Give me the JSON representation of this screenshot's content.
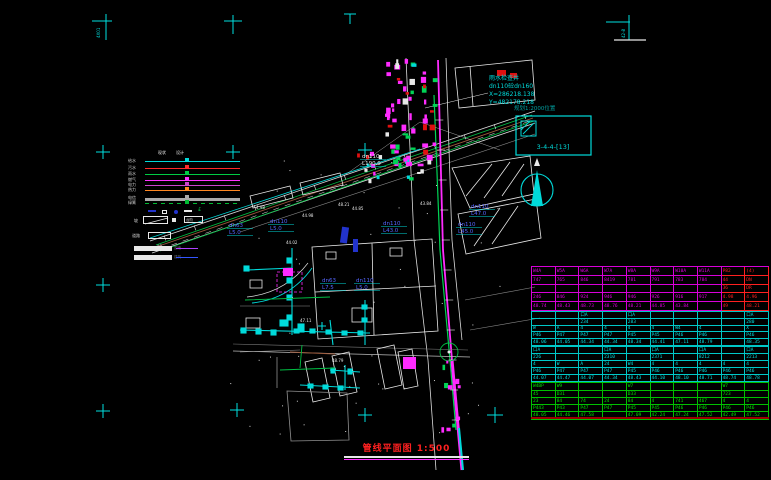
{
  "title_block": {
    "title": "管线平面图",
    "scale": "1:500"
  },
  "corner_notes": {
    "tl": "4X01",
    "tr": "42-8"
  },
  "survey_note": {
    "line1": "雨水检查井",
    "line2": "dn110砼dn160",
    "line3": "X=286218.138",
    "line4": "Y=482178.218"
  },
  "index_note": "规划1:2000位置",
  "detail_box": {
    "label": "3-4-4-[13]"
  },
  "north_label": "北",
  "legend": {
    "col_headers": [
      "现状",
      "设计"
    ],
    "lines": [
      {
        "label": "给水",
        "color": "#00dada",
        "style": "solid"
      },
      {
        "label": "污水",
        "color": "#ff2a2a",
        "style": "solid"
      },
      {
        "label": "雨水",
        "color": "#00cc44",
        "style": "solid"
      },
      {
        "label": "燃气",
        "color": "#ff33ff",
        "style": "solid"
      },
      {
        "label": "电力",
        "color": "#cc44cc",
        "style": "solid"
      },
      {
        "label": "热力",
        "color": "#ff8822",
        "style": "solid"
      },
      {
        "label": "电信",
        "color": "#aaaaaa",
        "style": "thick"
      },
      {
        "label": "绿篱",
        "color": "#00bb33",
        "style": "dashed"
      }
    ],
    "extra_labels": {
      "slope": "坡",
      "steps": "台阶",
      "road": "道路",
      "road_tag": "AB"
    },
    "bars": [
      "围墙",
      "建筑"
    ]
  },
  "pipe_labels": [
    {
      "x": 229,
      "y": 227,
      "l1": "dn63",
      "l2": "L5.0",
      "c": "#5566ff"
    },
    {
      "x": 270,
      "y": 223,
      "l1": "dn110",
      "l2": "L5.0",
      "c": "#5566ff"
    },
    {
      "x": 383,
      "y": 225,
      "l1": "dn110",
      "l2": "L43.0",
      "c": "#5566ff"
    },
    {
      "x": 458,
      "y": 226,
      "l1": "dn110",
      "l2": "L45.0",
      "c": "#5566ff"
    },
    {
      "x": 471,
      "y": 208,
      "l1": "dn110",
      "l2": "L47.0",
      "c": "#5566ff"
    },
    {
      "x": 362,
      "y": 158,
      "l1": "dn110",
      "l2": "L190.0",
      "c": "#e8e8e8"
    },
    {
      "x": 322,
      "y": 282,
      "l1": "dn63",
      "l2": "L7.5",
      "c": "#5566ff"
    },
    {
      "x": 356,
      "y": 282,
      "l1": "dn110",
      "l2": "L5.0",
      "c": "#5566ff"
    }
  ],
  "spot_elevations": [
    {
      "x": 302,
      "y": 217,
      "t": "44.98"
    },
    {
      "x": 338,
      "y": 206,
      "t": "48.21"
    },
    {
      "x": 256,
      "y": 209,
      "t": "4.98"
    },
    {
      "x": 286,
      "y": 244,
      "t": "44.02"
    },
    {
      "x": 352,
      "y": 210,
      "t": "44.85"
    },
    {
      "x": 420,
      "y": 205,
      "t": "43.84"
    },
    {
      "x": 300,
      "y": 322,
      "t": "47.11"
    },
    {
      "x": 332,
      "y": 362,
      "t": "48.79"
    }
  ],
  "tables": {
    "sections": [
      {
        "name": "rain-wells",
        "border": "#d800d8",
        "text": "#e000e0",
        "alt_border": "#ff2020",
        "alt_text": "#ff2020",
        "alt_cols": 2,
        "rows": [
          [
            "W4A",
            "W5A",
            "W6A",
            "W7A",
            "W8A",
            "W9A",
            "W10A",
            "W11A",
            "P82",
            "(4)"
          ],
          [
            "747",
            "765",
            "846",
            "8419",
            "781",
            "791",
            "783",
            "784",
            "44",
            "DN"
          ],
          [
            "",
            "",
            "",
            "",
            "",
            "",
            "",
            "",
            "36",
            "DR"
          ],
          [
            "246",
            "846",
            "924",
            "946",
            "946",
            "926",
            "916",
            "917",
            "4.98",
            "4.96"
          ],
          [
            "48.74",
            "48.43",
            "48.73",
            "48.76",
            "48.21",
            "44.85",
            "43.84",
            "",
            "49",
            "48.21"
          ]
        ]
      },
      {
        "name": "water-wells-1",
        "border": "#00c8c8",
        "text": "#00e0e0",
        "rows": [
          [
            "",
            "",
            "口A",
            "",
            "口A",
            "",
            "",
            "",
            "",
            "口A"
          ],
          [
            "",
            "",
            "234",
            "",
            "283",
            "",
            "",
            "",
            "",
            "280"
          ],
          [
            "W",
            "A",
            "4",
            "4",
            "4",
            "4",
            "W4",
            "4",
            "",
            "X"
          ],
          [
            "P46",
            "P47",
            "P47",
            "P47",
            "P45",
            "P45",
            "P46",
            "P46",
            "",
            "P46"
          ],
          [
            "48.06",
            "44.05",
            "44.34",
            "44.34",
            "48.34",
            "44.41",
            "47.11",
            "48.79",
            "",
            "48.35"
          ]
        ]
      },
      {
        "name": "water-wells-2",
        "border": "#00c8c8",
        "text": "#00e0e0",
        "rows": [
          [
            "口A",
            "",
            "",
            "口A",
            "",
            "口A",
            "",
            "口A",
            "",
            "口A"
          ],
          [
            "226",
            "",
            "",
            "2310",
            "",
            "2371",
            "",
            "8212",
            "",
            "2213"
          ],
          [
            "4",
            "W",
            "A",
            "24",
            "W4",
            "4",
            "4",
            "4",
            "4",
            "4"
          ],
          [
            "P46",
            "P47",
            "P47",
            "P47",
            "P45",
            "P46",
            "P46",
            "P46",
            "P46",
            "P46"
          ],
          [
            "44.07",
            "44.47",
            "44.07",
            "44.34",
            "48.43",
            "44.10",
            "48.10",
            "48.71",
            "48.74",
            "48.78"
          ]
        ]
      },
      {
        "name": "sewer-wells",
        "border": "#00c000",
        "text": "#00e000",
        "rows": [
          [
            "W4BP",
            "W9",
            "",
            "",
            "W7",
            "",
            "",
            "",
            "W7",
            ""
          ],
          [
            "45",
            "D31",
            "",
            "",
            "D33",
            "",
            "",
            "",
            "723",
            ""
          ],
          [
            "23",
            "84",
            "74",
            "24",
            "84",
            "4",
            "741",
            "467",
            "4",
            "4"
          ],
          [
            "P443",
            "P43",
            "P47",
            "P47",
            "P45",
            "P45",
            "P46",
            "P46",
            "P46",
            "P46"
          ],
          [
            "48.05",
            "44.46",
            "47.58",
            "",
            "47.09",
            "42.24",
            "47.24",
            "47.52",
            "42.49",
            "47.52"
          ]
        ]
      }
    ]
  },
  "colors": {
    "mark": "#00e0e0",
    "magenta": "#ff2bff",
    "green": "#00d455",
    "cyan": "#00dada",
    "red": "#e01010",
    "white": "#e8e8e8",
    "brown": "#9c5a3c",
    "blue": "#2233cc",
    "title_red": "#ff2020"
  }
}
